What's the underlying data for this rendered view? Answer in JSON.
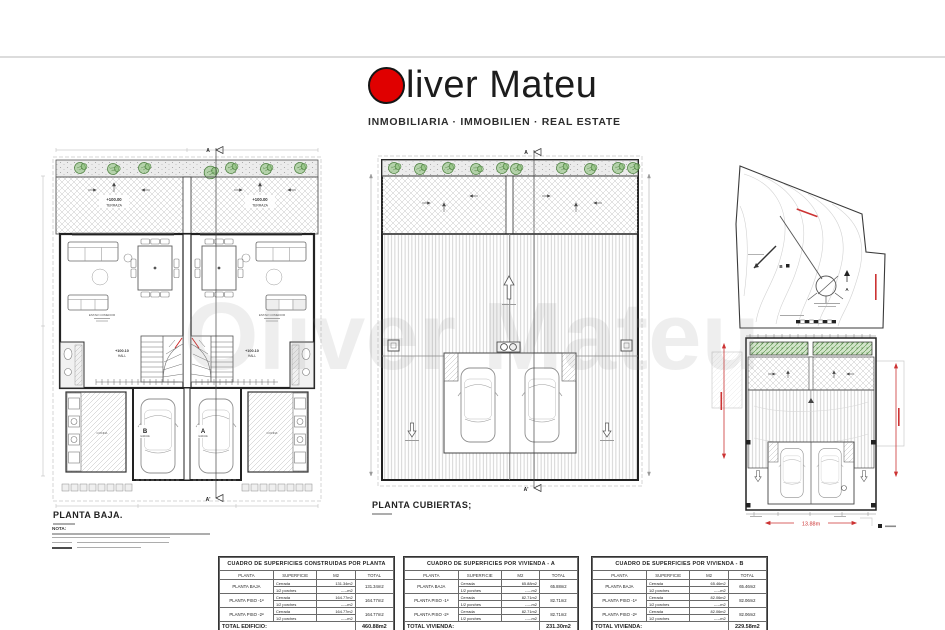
{
  "colors": {
    "logo_red": "#e00000",
    "accent_red": "#cc2222",
    "plant_green": "#4a7f3c"
  },
  "brand": {
    "name": "Oliver Mateu",
    "name_rest": "liver Mateu",
    "tagline": "INMOBILIARIA · IMMOBILIEN · REAL ESTATE"
  },
  "watermark": {
    "text": "Oliver Mateu"
  },
  "plans": {
    "baja": {
      "title": "PLANTA BAJA.",
      "note_title": "NOTA:",
      "section_start": "A",
      "section_end": "A'",
      "unit_b": "B",
      "unit_a": "A",
      "level_terrace": "+100.00",
      "terrace": "TERRAZA",
      "level_hall": "+100.10",
      "hall": "HALL",
      "living": "ESTAR COMEDOR",
      "kitchen": "COCINA",
      "garage": "GARAJE"
    },
    "cubiertas": {
      "title": "PLANTA CUBIERTAS;",
      "section_start": "A",
      "section_end": "A'"
    },
    "site": {
      "unit_b": "B",
      "unit_a": "A",
      "dim_width": "13.88m"
    }
  },
  "tables": [
    {
      "title": "CUADRO DE SUPERFICIES CONSTRUIDAS POR PLANTA",
      "headers": [
        "PLANTA",
        "SUPERFICIE",
        "M2",
        "TOTAL"
      ],
      "rows": [
        {
          "planta": "PLANTA BAJA",
          "l1": "Cerrada",
          "v1": "131.34m2",
          "l2": "1/2 porches",
          "v2": "-----m2",
          "total": "131.34m2"
        },
        {
          "planta": "PLANTA PISO -1ª",
          "l1": "Cerrada",
          "v1": "164.77m2",
          "l2": "1/2 porches",
          "v2": "-----m2",
          "total": "164.77m2"
        },
        {
          "planta": "PLANTA PISO -2ª",
          "l1": "Cerrada",
          "v1": "164.77m2",
          "l2": "1/2 porches",
          "v2": "-----m2",
          "total": "164.77m2"
        }
      ],
      "total_label": "TOTAL EDIFICIO:",
      "total_value": "460.88m2"
    },
    {
      "title": "CUADRO DE SUPERFICIES POR VIVIENDA - A",
      "headers": [
        "PLANTA",
        "SUPERFICIE",
        "M2",
        "TOTAL"
      ],
      "rows": [
        {
          "planta": "PLANTA BAJA",
          "l1": "Cerrada",
          "v1": "65.88m2",
          "l2": "1/2 porches",
          "v2": "-----m2",
          "total": "65.88m2"
        },
        {
          "planta": "PLANTA PISO -1ª",
          "l1": "Cerrada",
          "v1": "82.71m2",
          "l2": "1/2 porches",
          "v2": "-----m2",
          "total": "82.71m2"
        },
        {
          "planta": "PLANTA PISO -2ª",
          "l1": "Cerrada",
          "v1": "82.71m2",
          "l2": "1/2 porches",
          "v2": "-----m2",
          "total": "82.71m2"
        }
      ],
      "total_label": "TOTAL VIVIENDA:",
      "total_value": "231.30m2"
    },
    {
      "title": "CUADRO DE SUPERFICIES POR VIVIENDA - B",
      "headers": [
        "PLANTA",
        "SUPERFICIE",
        "M2",
        "TOTAL"
      ],
      "rows": [
        {
          "planta": "PLANTA BAJA",
          "l1": "Cerrada",
          "v1": "65.46m2",
          "l2": "1/2 porches",
          "v2": "-----m2",
          "total": "65.46m2"
        },
        {
          "planta": "PLANTA PISO -1ª",
          "l1": "Cerrada",
          "v1": "82.06m2",
          "l2": "1/2 porches",
          "v2": "-----m2",
          "total": "82.06m2"
        },
        {
          "planta": "PLANTA PISO -2ª",
          "l1": "Cerrada",
          "v1": "82.06m2",
          "l2": "1/2 porches",
          "v2": "-----m2",
          "total": "82.06m2"
        }
      ],
      "total_label": "TOTAL VIVIENDA:",
      "total_value": "229.58m2"
    }
  ]
}
